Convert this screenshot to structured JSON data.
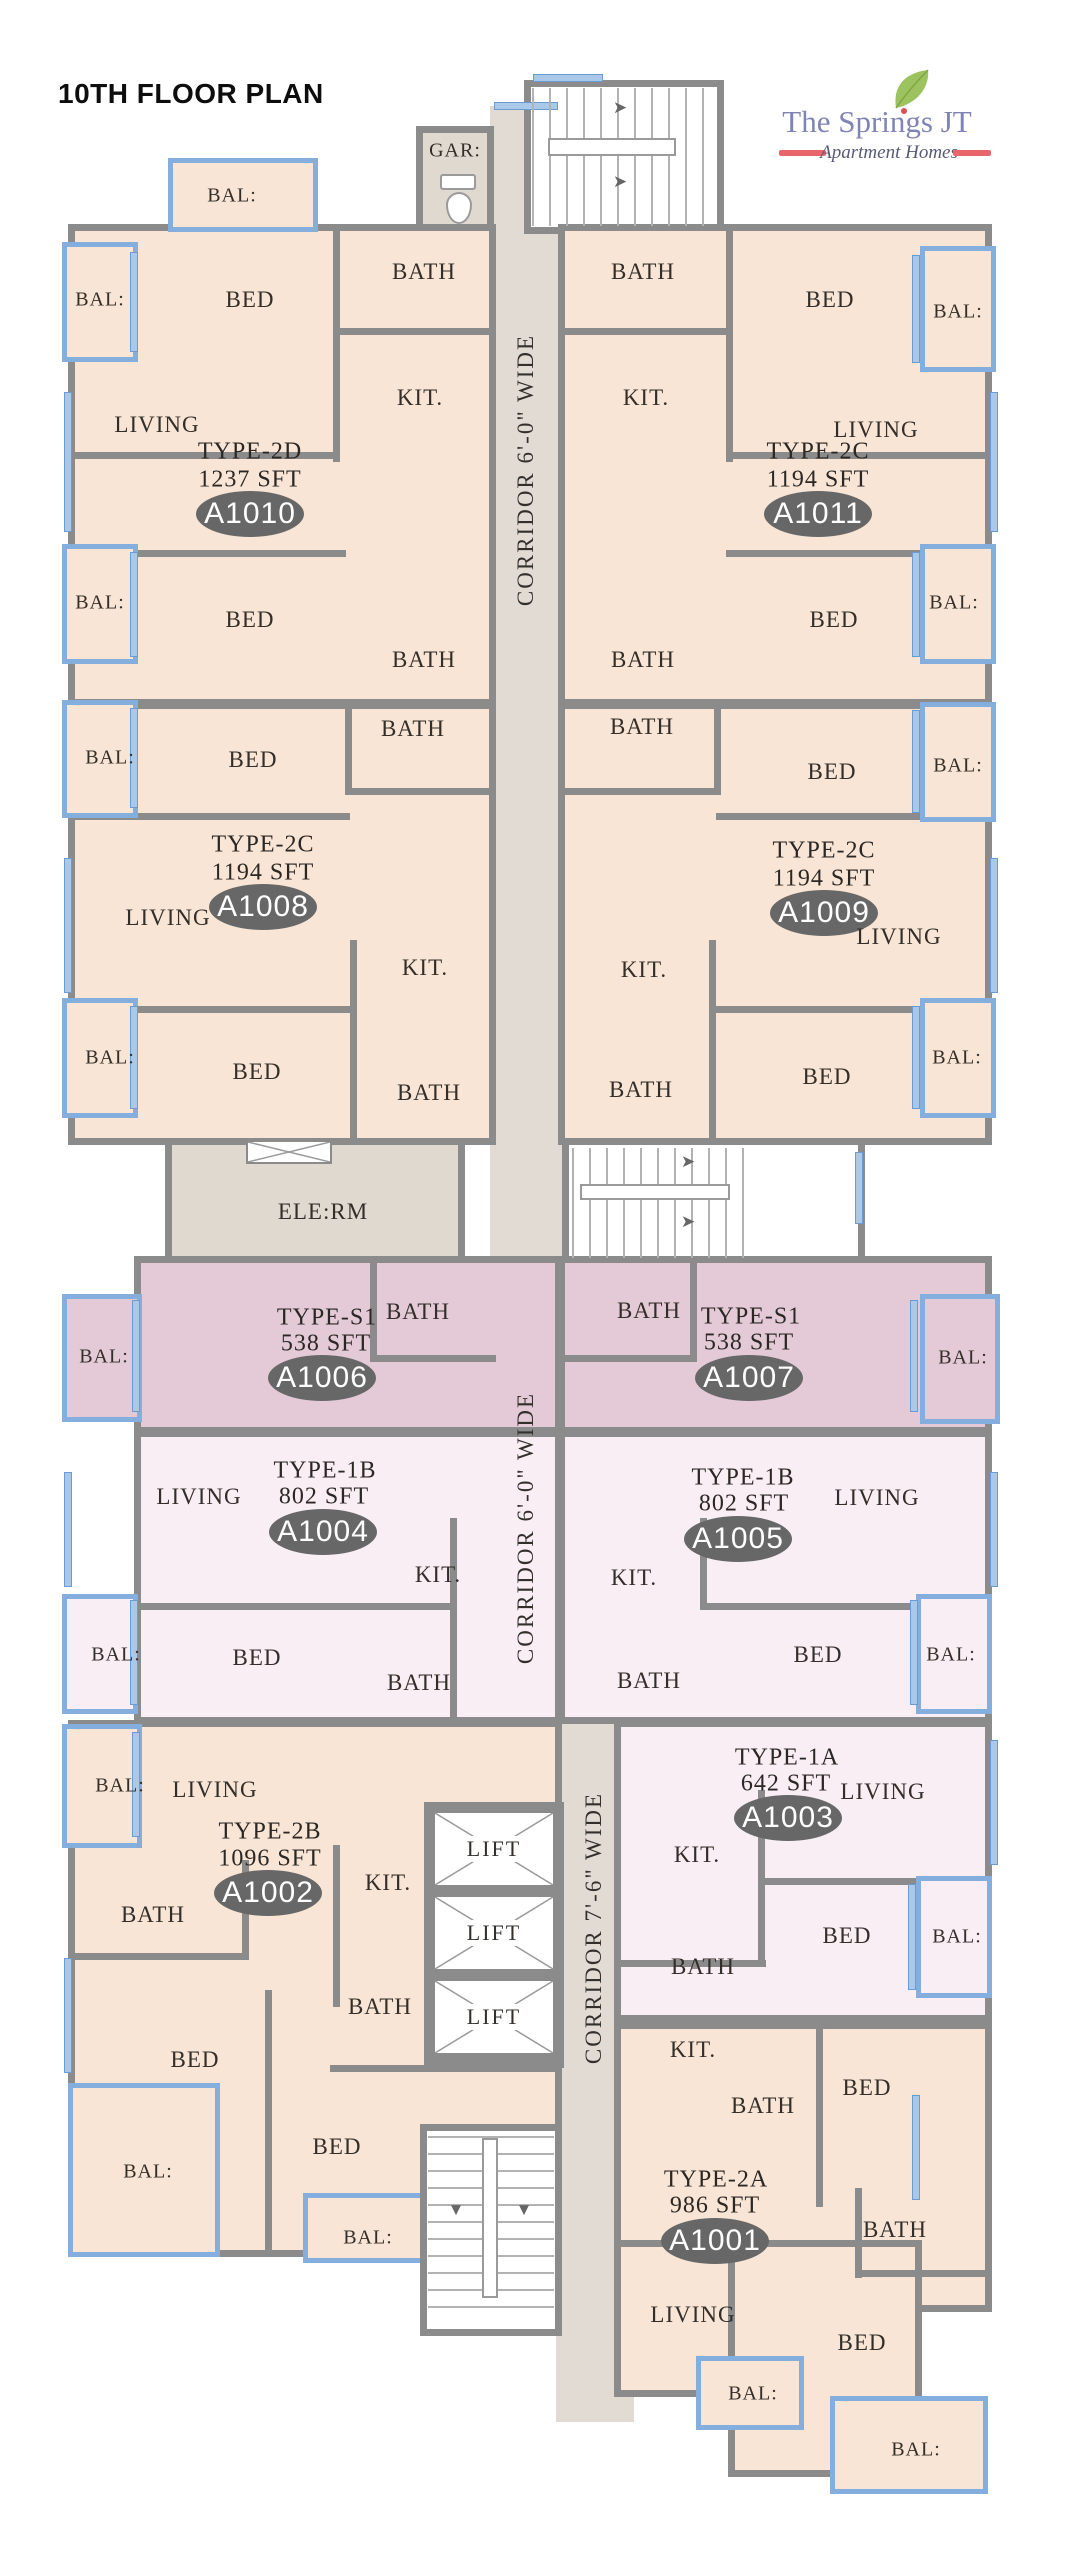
{
  "page": {
    "title": "10TH FLOOR PLAN"
  },
  "logo": {
    "name": "The Springs JT",
    "tagline": "Apartment Homes"
  },
  "colors": {
    "unit_peach": "#f8e5d5",
    "unit_mauve": "#e4cad7",
    "unit_pink": "#f9eef3",
    "corridor_fill": "#e2dbd3",
    "service_fill": "#e0d9d0",
    "wall_gray": "#8b8b8b",
    "balcony_blue": "#84aede",
    "window_blue": "#aac9e9",
    "badge_gray": "#676767",
    "logo_purple": "#8083b5",
    "logo_red": "#e8666b",
    "leaf_green": "#9cc360"
  },
  "corridors": {
    "top": "CORRIDOR 6'-0\" WIDE",
    "mid": "CORRIDOR 6'-0\" WIDE",
    "bottom": "CORRIDOR 7'-6\" WIDE"
  },
  "common": {
    "gar": "GAR:",
    "ele_rm": "ELE:RM",
    "lift1": "LIFT",
    "lift2": "LIFT",
    "lift3": "LIFT"
  },
  "units": {
    "a1010": {
      "id": "A1010",
      "type": "TYPE-2D",
      "area": "1237 SFT",
      "rooms": {
        "bal_top": "BAL:",
        "bed1": "BED",
        "bath1": "BATH",
        "bal1": "BAL:",
        "living": "LIVING",
        "kit": "KIT.",
        "bed2": "BED",
        "bath2": "BATH",
        "bal2": "BAL:"
      }
    },
    "a1011": {
      "id": "A1011",
      "type": "TYPE-2C",
      "area": "1194 SFT",
      "rooms": {
        "bath1": "BATH",
        "bed1": "BED",
        "bal1": "BAL:",
        "kit": "KIT.",
        "living": "LIVING",
        "bed2": "BED",
        "bath2": "BATH",
        "bal2": "BAL:"
      }
    },
    "a1008": {
      "id": "A1008",
      "type": "TYPE-2C",
      "area": "1194 SFT",
      "rooms": {
        "bath1": "BATH",
        "bed1": "BED",
        "bal1": "BAL:",
        "living": "LIVING",
        "kit": "KIT.",
        "bed2": "BED",
        "bath2": "BATH",
        "bal2": "BAL:"
      }
    },
    "a1009": {
      "id": "A1009",
      "type": "TYPE-2C",
      "area": "1194 SFT",
      "rooms": {
        "bath1": "BATH",
        "bed1": "BED",
        "bal1": "BAL:",
        "kit": "KIT.",
        "living": "LIVING",
        "bed2": "BED",
        "bath2": "BATH",
        "bal2": "BAL:"
      }
    },
    "a1006": {
      "id": "A1006",
      "type": "TYPE-S1",
      "area": "538 SFT",
      "rooms": {
        "bath": "BATH",
        "bal": "BAL:"
      }
    },
    "a1007": {
      "id": "A1007",
      "type": "TYPE-S1",
      "area": "538 SFT",
      "rooms": {
        "bath": "BATH",
        "bal": "BAL:"
      }
    },
    "a1004": {
      "id": "A1004",
      "type": "TYPE-1B",
      "area": "802 SFT",
      "rooms": {
        "living": "LIVING",
        "kit": "KIT.",
        "bed": "BED",
        "bath": "BATH",
        "bal": "BAL:"
      }
    },
    "a1005": {
      "id": "A1005",
      "type": "TYPE-1B",
      "area": "802 SFT",
      "rooms": {
        "living": "LIVING",
        "kit": "KIT.",
        "bed": "BED",
        "bath": "BATH",
        "bal": "BAL:"
      }
    },
    "a1002": {
      "id": "A1002",
      "type": "TYPE-2B",
      "area": "1096 SFT",
      "rooms": {
        "bal1": "BAL:",
        "living": "LIVING",
        "kit": "KIT.",
        "bath1": "BATH",
        "bed1": "BED",
        "bath2": "BATH",
        "bed2": "BED",
        "bal2": "BAL:",
        "bal3": "BAL:"
      }
    },
    "a1003": {
      "id": "A1003",
      "type": "TYPE-1A",
      "area": "642 SFT",
      "rooms": {
        "living": "LIVING",
        "kit": "KIT.",
        "bed": "BED",
        "bath": "BATH",
        "bal": "BAL:"
      }
    },
    "a1001": {
      "id": "A1001",
      "type": "TYPE-2A",
      "area": "986 SFT",
      "rooms": {
        "kit": "KIT.",
        "bath1": "BATH",
        "bed1": "BED",
        "bath2": "BATH",
        "living": "LIVING",
        "bed2": "BED",
        "bal1": "BAL:",
        "bal2": "BAL:"
      }
    }
  }
}
